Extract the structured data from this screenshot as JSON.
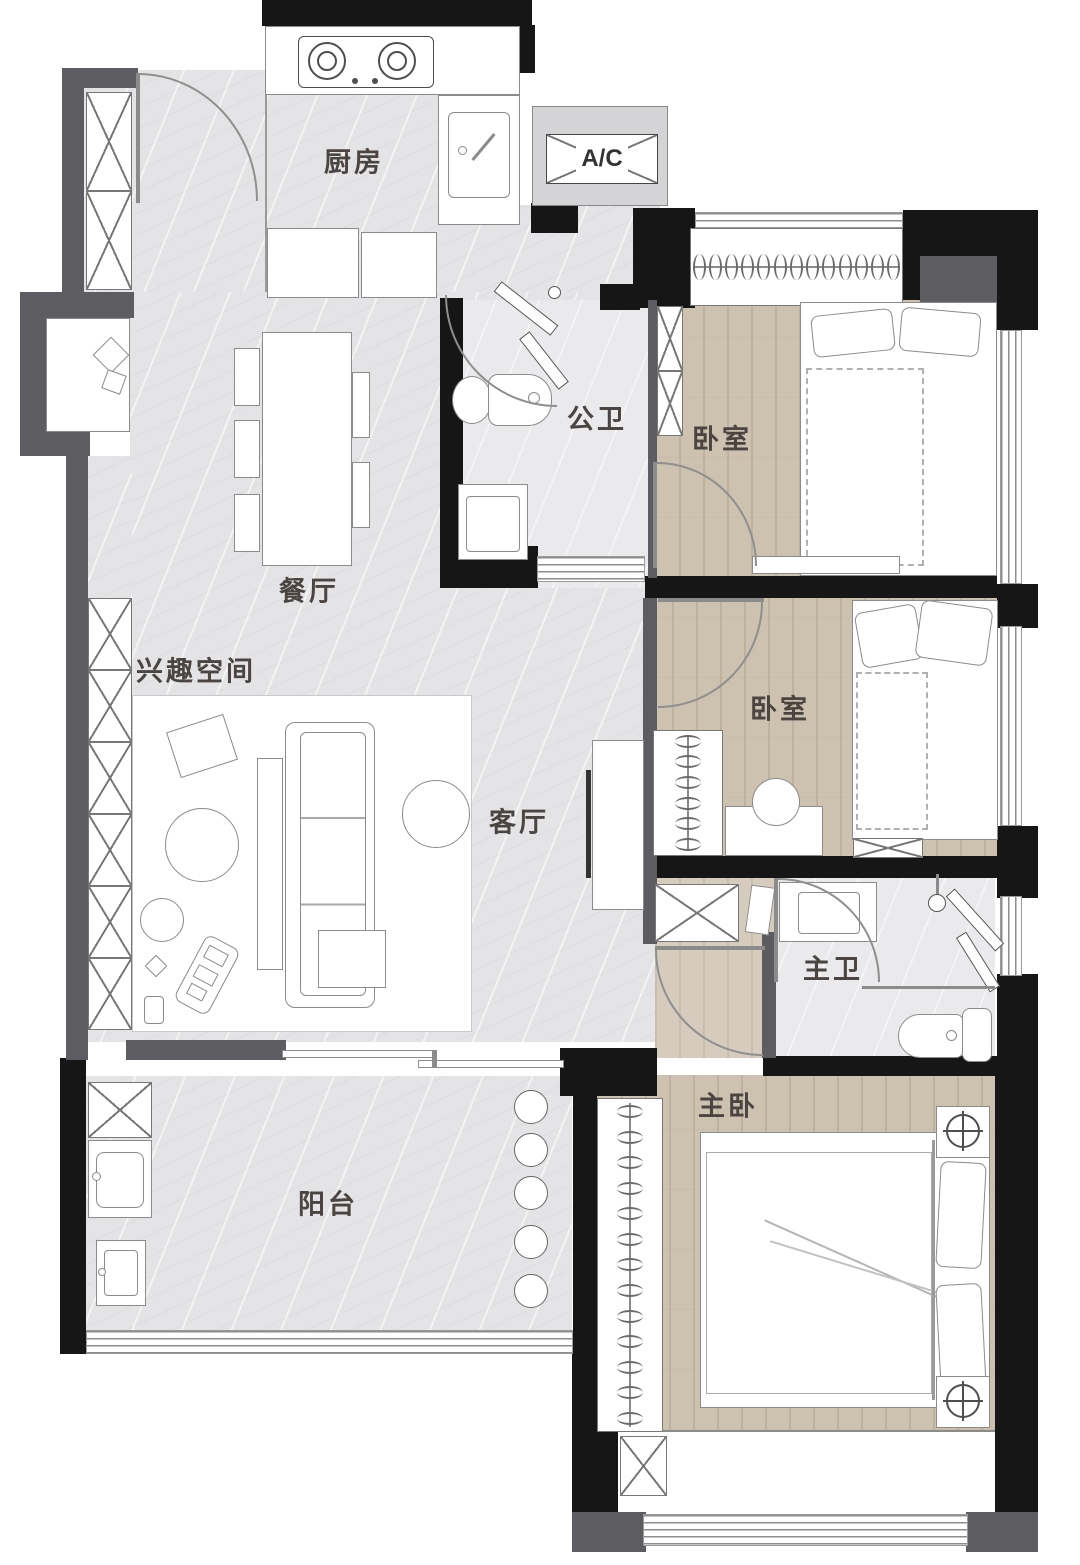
{
  "plan": {
    "labels": {
      "kitchen": "厨房",
      "ac_unit": "A/C",
      "guest_bathroom": "公卫",
      "bedroom_upper": "卧室",
      "bedroom_middle": "卧室",
      "dining_room": "餐厅",
      "hobby_space": "兴趣空间",
      "living_room": "客厅",
      "master_bathroom": "主卫",
      "master_bedroom": "主卧",
      "balcony": "阳台"
    },
    "colors": {
      "wall_main": "#161616",
      "wall_secondary": "#5d5d61",
      "floor_marble": "#e4e4e6",
      "floor_bath": "#eaeaec",
      "floor_wood": "#cdc2b0",
      "furniture_line": "#8b8b8b",
      "label_text": "#4a4540"
    }
  }
}
